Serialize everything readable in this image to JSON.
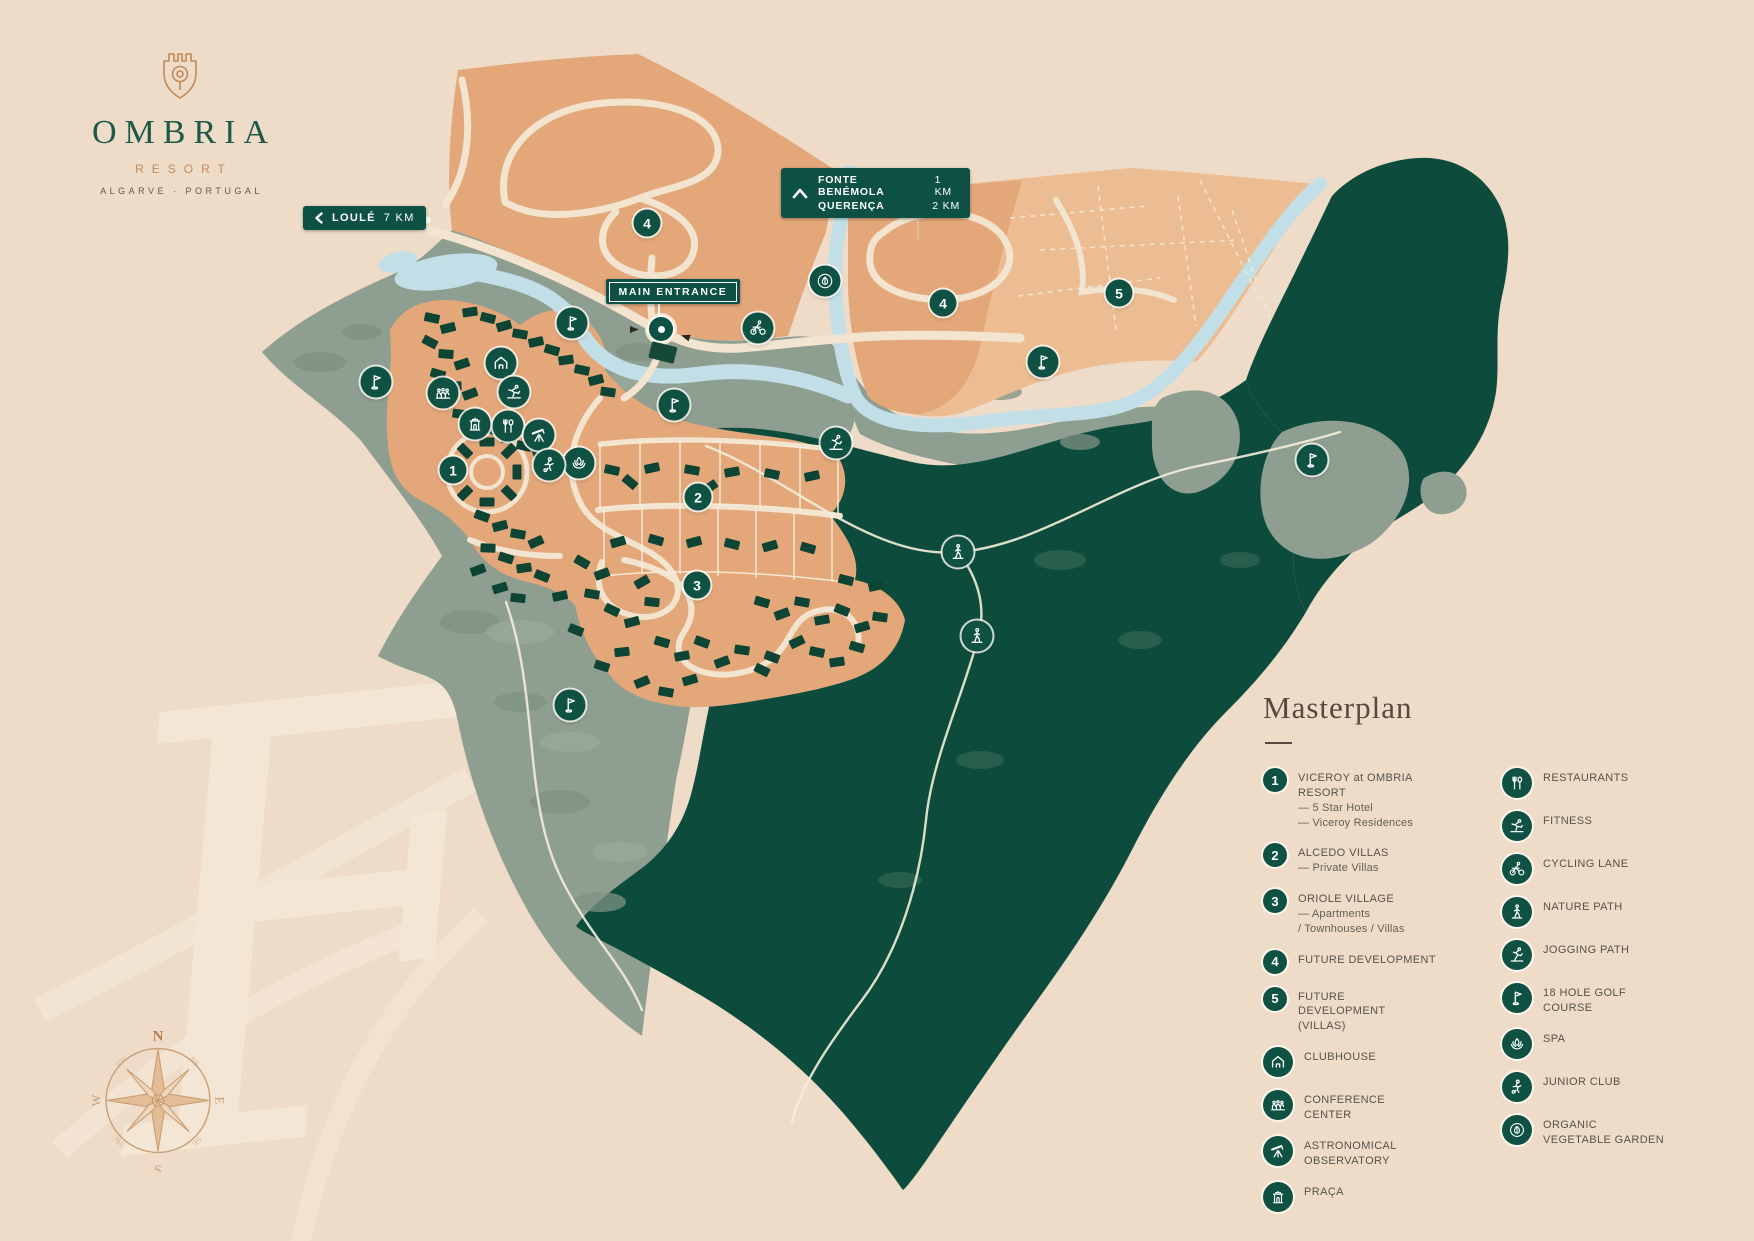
{
  "logo": {
    "name": "OMBRIA",
    "subtitle": "RESORT",
    "location": "ALGARVE · PORTUGAL"
  },
  "signs": {
    "loule": {
      "label": "LOULÉ",
      "distance": "7 KM"
    },
    "fonte": {
      "row1": {
        "name": "FONTE BENÉMOLA",
        "km": "1 KM"
      },
      "row2": {
        "name": "QUERENÇA",
        "km": "2 KM"
      }
    },
    "main_entrance": "MAIN ENTRANCE"
  },
  "legend": {
    "title": "Masterplan",
    "left": [
      {
        "num": "1",
        "title": "VICEROY at OMBRIA RESORT",
        "sub1": "— 5 Star Hotel",
        "sub2": "— Viceroy Residences"
      },
      {
        "num": "2",
        "title": "ALCEDO VILLAS",
        "sub1": "— Private Villas"
      },
      {
        "num": "3",
        "title": "ORIOLE VILLAGE",
        "sub1": "— Apartments",
        "sub2": "/ Townhouses / Villas"
      },
      {
        "num": "4",
        "title": "FUTURE DEVELOPMENT"
      },
      {
        "num": "5",
        "title": "FUTURE DEVELOPMENT (VILLAS)"
      },
      {
        "icon": "clubhouse",
        "title": "CLUBHOUSE"
      },
      {
        "icon": "conference",
        "title": "CONFERENCE CENTER"
      },
      {
        "icon": "observatory",
        "title": "ASTRONOMICAL OBSERVATORY"
      },
      {
        "icon": "praca",
        "title": "PRAÇA"
      }
    ],
    "right": [
      {
        "icon": "restaurants",
        "title": "RESTAURANTS"
      },
      {
        "icon": "fitness",
        "title": "FITNESS"
      },
      {
        "icon": "cycling",
        "title": "CYCLING LANE"
      },
      {
        "icon": "nature",
        "title": "NATURE PATH"
      },
      {
        "icon": "jogging",
        "title": "JOGGING PATH"
      },
      {
        "icon": "golf",
        "title": "18 HOLE GOLF COURSE"
      },
      {
        "icon": "spa",
        "title": "SPA"
      },
      {
        "icon": "junior",
        "title": "JUNIOR CLUB"
      },
      {
        "icon": "garden",
        "title": "ORGANIC VEGETABLE GARDEN"
      }
    ]
  },
  "map": {
    "markers": {
      "m1": "1",
      "m2": "2",
      "m3": "3",
      "m4a": "4",
      "m4b": "4",
      "m5": "5"
    },
    "compass": {
      "n": "N",
      "s": "S",
      "e": "E",
      "w": "W"
    }
  },
  "colors": {
    "brand_green": "#1d5948",
    "copper": "#c08a5c",
    "sign_green": "#0d5145",
    "forest": "#0d4c3c",
    "sage": "#8e9e90",
    "development_orange": "#e3a77a",
    "development_light": "#ecbd92",
    "river": "#c2dfe8",
    "background": "#eedcc9"
  }
}
